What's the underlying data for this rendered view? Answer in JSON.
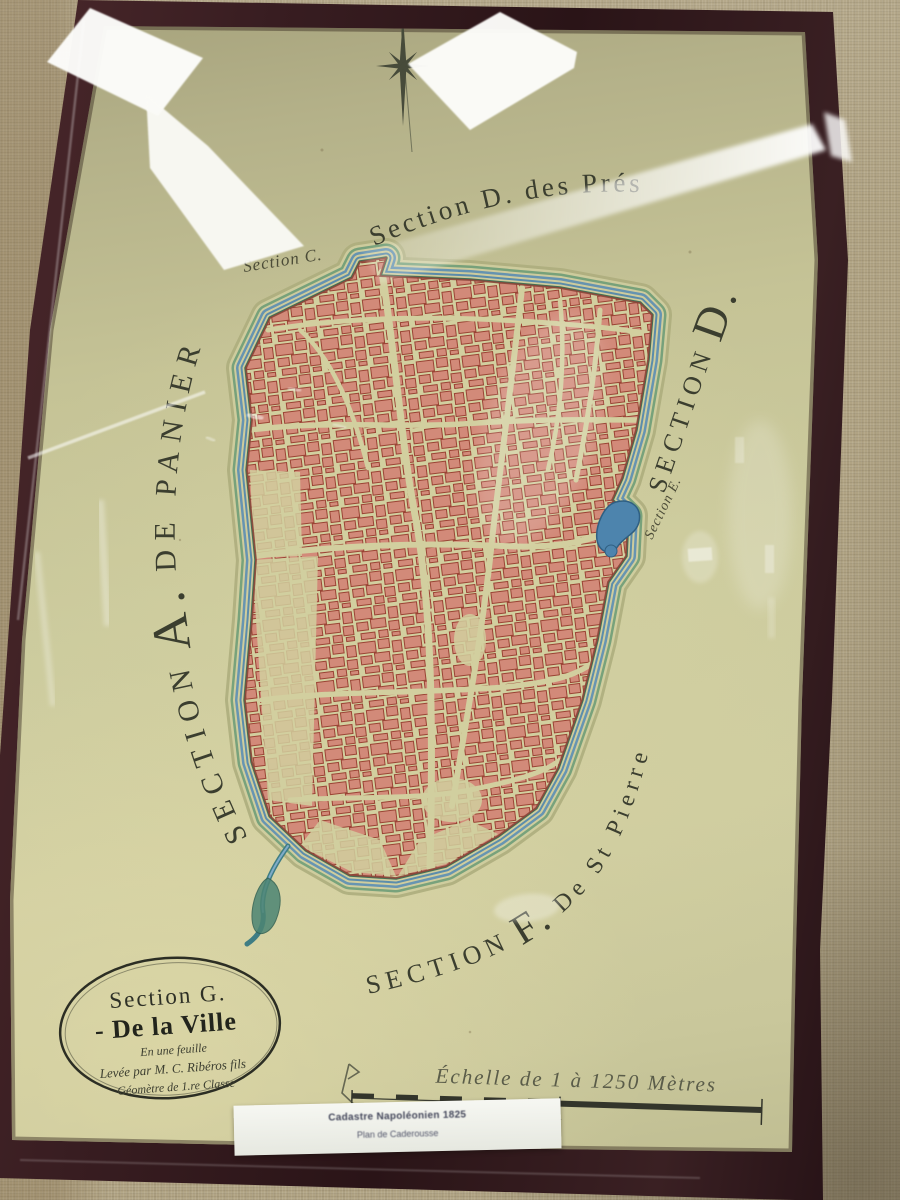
{
  "labels": {
    "top": "Section D. des Prés",
    "sectionC": "Section C.",
    "leftPre": "SECTION",
    "leftBig": "A.",
    "leftPost": "DE PANIER",
    "rightPre": "SECTION",
    "rightBig": "D.",
    "sectionE": "Section E.",
    "botPre": "SECTION",
    "botBig": "F.",
    "botPost": "De St Pierre",
    "corner": "Caderousse"
  },
  "cartouche": {
    "l1": "Section G.",
    "l2": "- De la Ville",
    "l3": "En une feuille",
    "l4": "Levée par M. C. Ribéros fils",
    "l5": "Géomètre de 1.re Classe"
  },
  "scaleText": "Échelle de 1 à 1250 Mètres",
  "card": {
    "l1": "Cadastre Napoléonien 1825",
    "l2": "Plan de Caderousse"
  },
  "colors": {
    "paper": "#c9c79b",
    "frame": "#341c20",
    "wall": "#b0a383",
    "building_fill": "#d28a79",
    "building_stroke": "#9a4334",
    "moat_blue": "#4f86ad",
    "moat_green": "#6f9e78",
    "ink": "#3b3e2f"
  }
}
